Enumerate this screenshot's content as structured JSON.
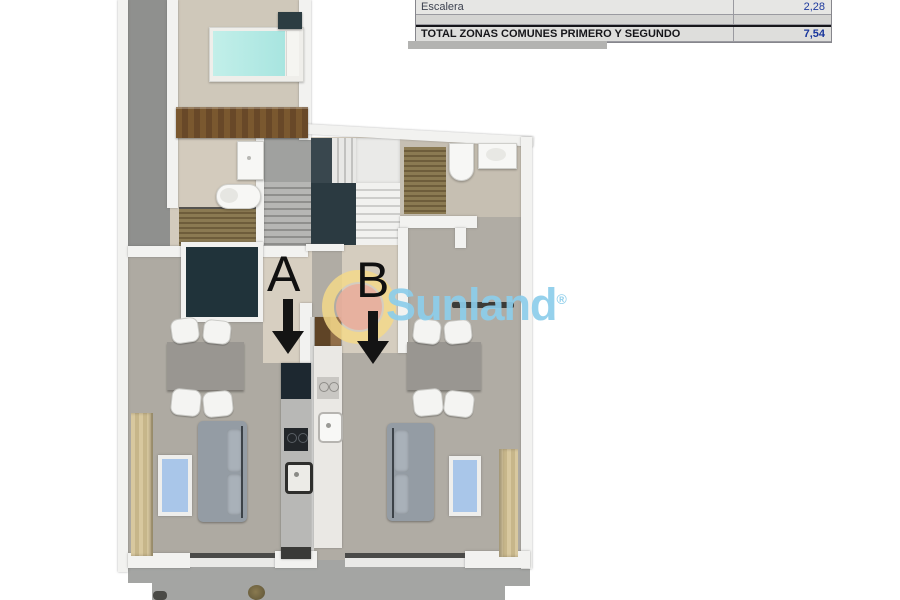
{
  "summary_table": {
    "rows": [
      {
        "label": "Escalera",
        "value": "2,28"
      },
      {
        "label": "",
        "value": ""
      },
      {
        "label": "TOTAL ZONAS COMUNES PRIMERO Y SEGUNDO",
        "value": "7,54"
      }
    ],
    "value_color": "#1e3a9e"
  },
  "watermark": {
    "brand": "Sunland",
    "registered_mark": "®",
    "text_color": "#8ccdea",
    "ring_color": "#f3d88a",
    "dot_color": "#e9ae9b"
  },
  "annotations": {
    "unit_a_label": "A",
    "unit_b_label": "B",
    "arrow_color": "#141414"
  },
  "plan_colors": {
    "living_floor": "#aeaaa2",
    "hall_floor": "#d3cbbd",
    "terrace_floor": "#a4a5a3",
    "corridor_gray": "#8f908e",
    "bed": "#b4eae4",
    "window_glass": "#a9c6e9",
    "stair_landing": "#2b3a41",
    "tv_panel": "#20333a"
  }
}
